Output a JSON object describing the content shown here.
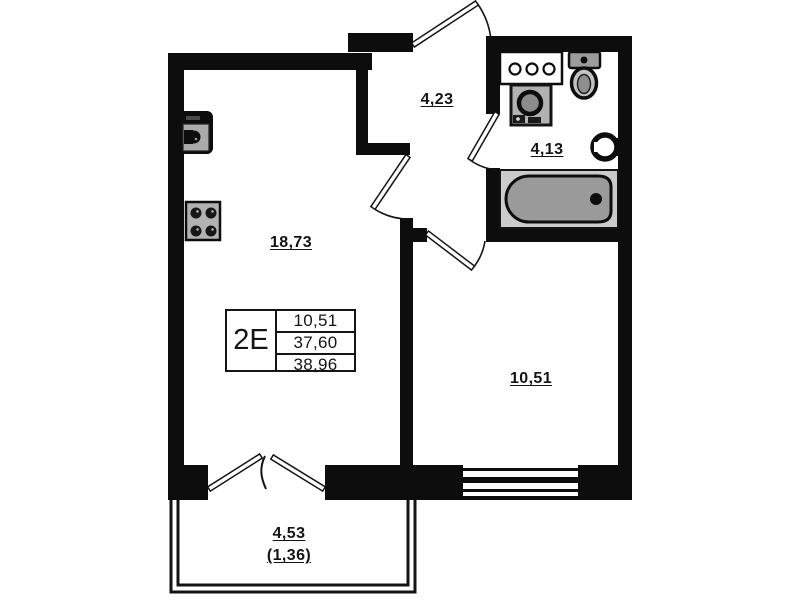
{
  "plan": {
    "unit": {
      "type_label": "2E",
      "areas": [
        "10,51",
        "37,60",
        "38,96"
      ]
    },
    "rooms": {
      "hallway": {
        "area": "4,23"
      },
      "bathroom": {
        "area": "4,13"
      },
      "living_kitchen": {
        "area": "18,73"
      },
      "bedroom": {
        "area": "10,51"
      },
      "balcony": {
        "area": "4,53",
        "area_weighted": "(1,36)"
      }
    },
    "fixtures": [
      "kitchen-sink-icon",
      "stove-icon",
      "vanity-basin-icon",
      "washing-machine-icon",
      "toilet-icon",
      "towel-dryer-icon",
      "bathtub-icon",
      "window-icon",
      "entry-door-icon",
      "interior-door-icon",
      "french-balcony-door-icon"
    ],
    "colors": {
      "wall": "#0d0d0d",
      "background": "#ffffff",
      "fixture_gray": "#b2b2b2",
      "tub_gray": "#9a9a9a",
      "tub_bg": "#cbcbcb"
    }
  }
}
